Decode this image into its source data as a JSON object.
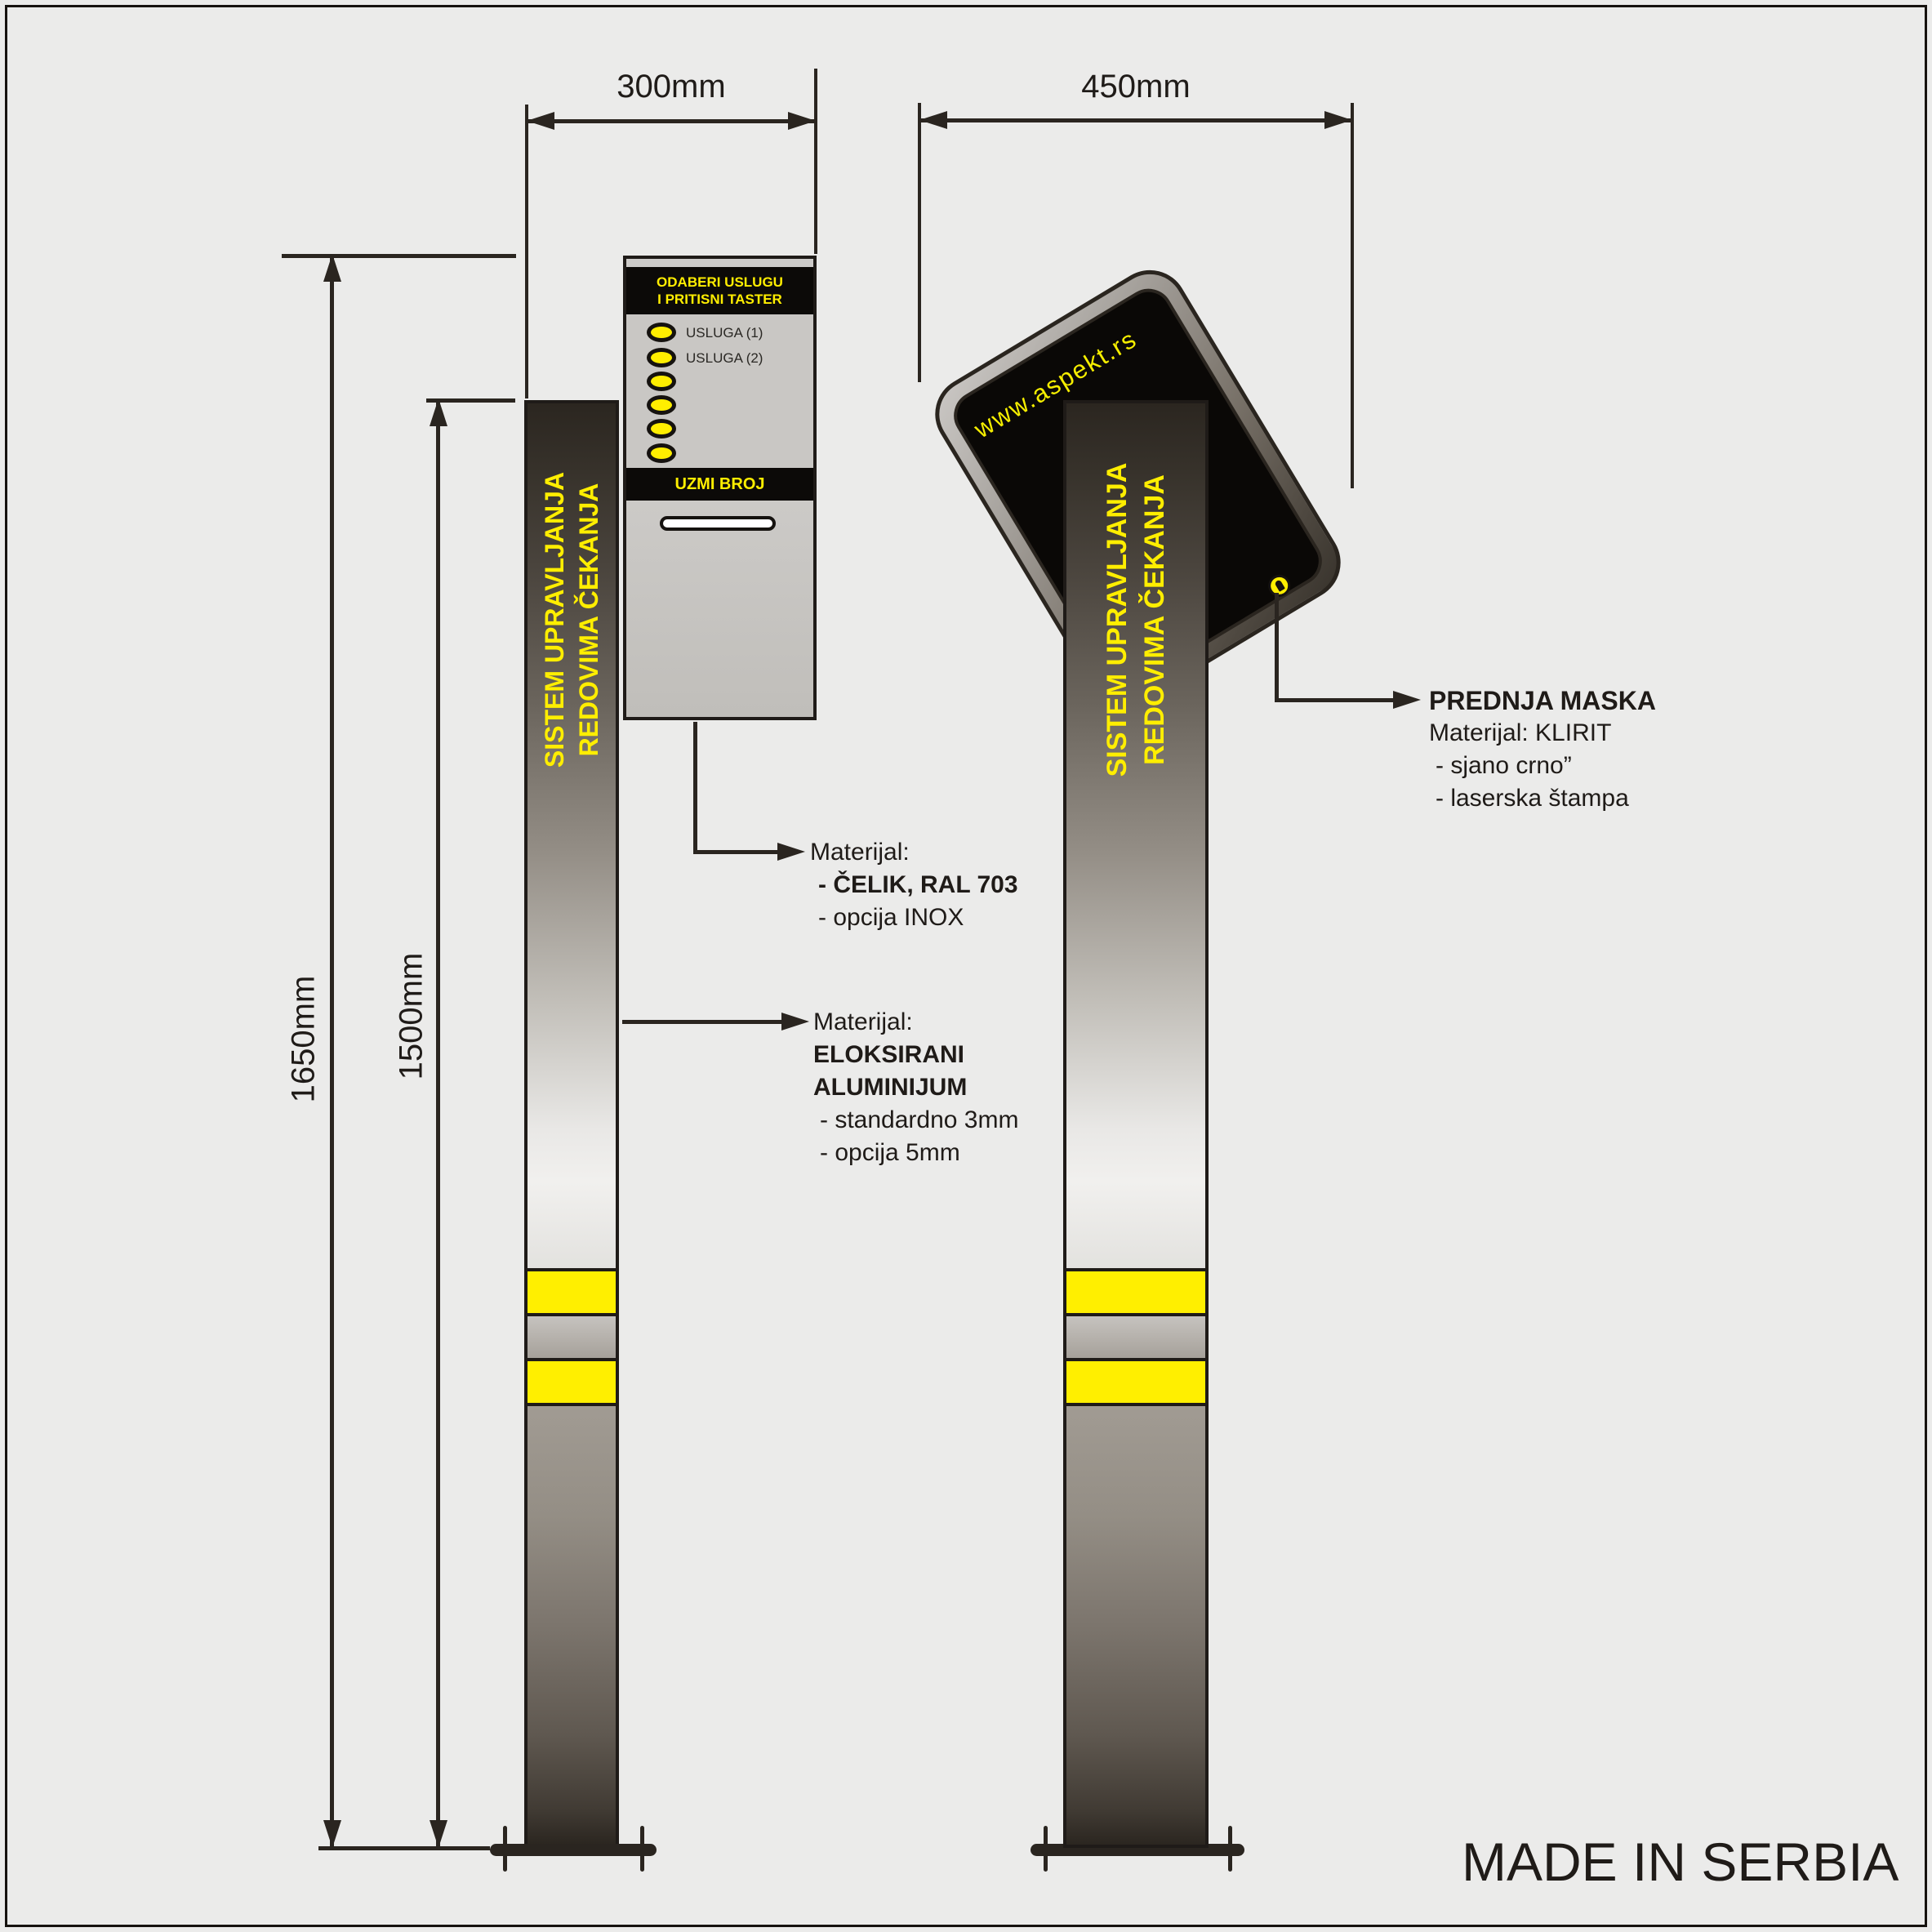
{
  "page": {
    "made_in": "MADE IN SERBIA",
    "background": "#ebebea",
    "accent_yellow": "#ffee00",
    "line_color": "#2a2520"
  },
  "dimensions": {
    "panel_width": "300mm",
    "mask_width": "450mm",
    "total_height": "1650mm",
    "pole_height": "1500mm"
  },
  "left_view": {
    "panel": {
      "header_line1": "ODABERI USLUGU",
      "header_line2": "I PRITISNI TASTER",
      "button1_label": "USLUGA (1)",
      "button2_label": "USLUGA (2)",
      "take_number_label": "UZMI BROJ"
    },
    "pole_text_line1": "SISTEM UPRAVLJANJA",
    "pole_text_line2": "REDOVIMA ČEKANJA"
  },
  "right_view": {
    "url": "www.aspekt.rs",
    "pole_text_line1": "SISTEM UPRAVLJANJA",
    "pole_text_line2": "REDOVIMA ČEKANJA"
  },
  "callouts": {
    "steel": {
      "title": "Materijal:",
      "line1": "- ČELIK, RAL 703",
      "line2": "- opcija INOX"
    },
    "aluminium": {
      "title": "Materijal:",
      "line1": "ELOKSIRANI",
      "line2": "ALUMINIJUM",
      "line3": "- standardno 3mm",
      "line4": "- opcija 5mm"
    },
    "mask": {
      "title": "PREDNJA MASKA",
      "line1": "Materijal: KLIRIT",
      "line2": "- sjano crno”",
      "line3": "- laserska štampa"
    }
  }
}
